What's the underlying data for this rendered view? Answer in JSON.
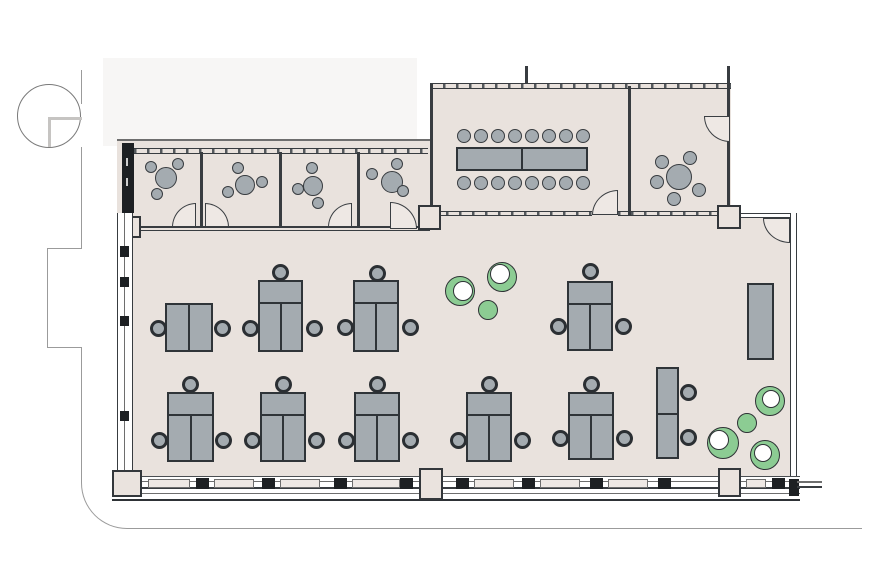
{
  "title": "office-floor-plan",
  "palette": {
    "floor": "#e9e2dd",
    "wall": "#383c40",
    "furniture_gray": "#a4abb0",
    "furniture_outline": "#2f3438",
    "chair_ring": "#2b2f33",
    "plant_green": "#8ccc93",
    "door_fill": "#eee8e4",
    "adjacent_area": "#f7f6f5",
    "site_line": "#9b9b9b"
  },
  "rooms": [
    {
      "id": "meeting-room-1"
    },
    {
      "id": "meeting-room-2"
    },
    {
      "id": "meeting-room-3"
    },
    {
      "id": "meeting-room-4"
    },
    {
      "id": "conference-room"
    },
    {
      "id": "round-table-room"
    },
    {
      "id": "open-office"
    }
  ],
  "summary": {
    "workstations": 10,
    "meeting_rooms": 4,
    "conference_seats": 16,
    "plants": 7,
    "doors": 7
  },
  "furniture": {
    "workstations": [
      {
        "x": 165,
        "y": 303,
        "w": 48,
        "h": 49,
        "kind": "double"
      },
      {
        "x": 258,
        "y": 280,
        "w": 45,
        "h": 72,
        "kind": "t3"
      },
      {
        "x": 353,
        "y": 280,
        "w": 46,
        "h": 72,
        "kind": "t3"
      },
      {
        "x": 567,
        "y": 281,
        "w": 46,
        "h": 70,
        "kind": "t3"
      },
      {
        "x": 167,
        "y": 392,
        "w": 47,
        "h": 70,
        "kind": "t3"
      },
      {
        "x": 260,
        "y": 392,
        "w": 46,
        "h": 70,
        "kind": "t3"
      },
      {
        "x": 354,
        "y": 392,
        "w": 46,
        "h": 70,
        "kind": "t3"
      },
      {
        "x": 466,
        "y": 392,
        "w": 46,
        "h": 70,
        "kind": "t3"
      },
      {
        "x": 568,
        "y": 392,
        "w": 46,
        "h": 68,
        "kind": "t3"
      },
      {
        "x": 656,
        "y": 367,
        "w": 23,
        "h": 92,
        "kind": "vertical"
      }
    ],
    "desk_chairs": [
      [
        158,
        328
      ],
      [
        222,
        328
      ],
      [
        280,
        272
      ],
      [
        250,
        328
      ],
      [
        314,
        328
      ],
      [
        377,
        273
      ],
      [
        345,
        327
      ],
      [
        410,
        327
      ],
      [
        590,
        271
      ],
      [
        558,
        326
      ],
      [
        623,
        326
      ],
      [
        190,
        384
      ],
      [
        159,
        440
      ],
      [
        223,
        440
      ],
      [
        283,
        384
      ],
      [
        252,
        440
      ],
      [
        316,
        440
      ],
      [
        377,
        384
      ],
      [
        346,
        440
      ],
      [
        410,
        440
      ],
      [
        489,
        384
      ],
      [
        458,
        440
      ],
      [
        522,
        440
      ],
      [
        591,
        384
      ],
      [
        560,
        438
      ],
      [
        624,
        438
      ],
      [
        688,
        392
      ],
      [
        688,
        437
      ]
    ],
    "round_tables": [
      [
        166,
        178,
        11
      ],
      [
        245,
        185,
        10
      ],
      [
        313,
        186,
        10
      ],
      [
        392,
        182,
        11
      ],
      [
        679,
        177,
        13
      ]
    ],
    "small_chairs": [
      [
        151,
        167,
        12
      ],
      [
        178,
        164,
        12
      ],
      [
        157,
        194,
        12
      ],
      [
        238,
        168,
        12
      ],
      [
        228,
        192,
        12
      ],
      [
        262,
        182,
        12
      ],
      [
        312,
        168,
        12
      ],
      [
        298,
        189,
        12
      ],
      [
        318,
        203,
        12
      ],
      [
        397,
        164,
        12
      ],
      [
        372,
        174,
        12
      ],
      [
        403,
        191,
        12
      ],
      [
        662,
        162,
        14
      ],
      [
        690,
        158,
        14
      ],
      [
        657,
        182,
        14
      ],
      [
        699,
        190,
        14
      ],
      [
        674,
        199,
        14
      ]
    ],
    "conference_table": {
      "x": 456,
      "y": 147,
      "w": 132,
      "h": 24,
      "divider_x": 521
    },
    "conference_chair_xs": [
      464,
      481,
      498,
      515,
      532,
      549,
      566,
      583
    ],
    "conference_chair_rows_y": [
      136,
      183
    ],
    "conference_chair_d": 14,
    "cabinet": {
      "x": 747,
      "y": 283,
      "w": 27,
      "h": 77
    },
    "plants": [
      {
        "cx": 460,
        "cy": 291,
        "r": 15,
        "style": "ring",
        "ix": 463,
        "iy": 291,
        "ir": 9
      },
      {
        "cx": 502,
        "cy": 277,
        "r": 15,
        "style": "ring",
        "ix": 500,
        "iy": 274,
        "ir": 9
      },
      {
        "cx": 488,
        "cy": 310,
        "r": 10,
        "style": "solid"
      },
      {
        "cx": 770,
        "cy": 401,
        "r": 15,
        "style": "ring",
        "ix": 771,
        "iy": 399,
        "ir": 8
      },
      {
        "cx": 747,
        "cy": 423,
        "r": 10,
        "style": "solid"
      },
      {
        "cx": 723,
        "cy": 443,
        "r": 16,
        "style": "ring",
        "ix": 719,
        "iy": 440,
        "ir": 9
      },
      {
        "cx": 765,
        "cy": 455,
        "r": 15,
        "style": "ring",
        "ix": 763,
        "iy": 453,
        "ir": 8
      }
    ]
  }
}
